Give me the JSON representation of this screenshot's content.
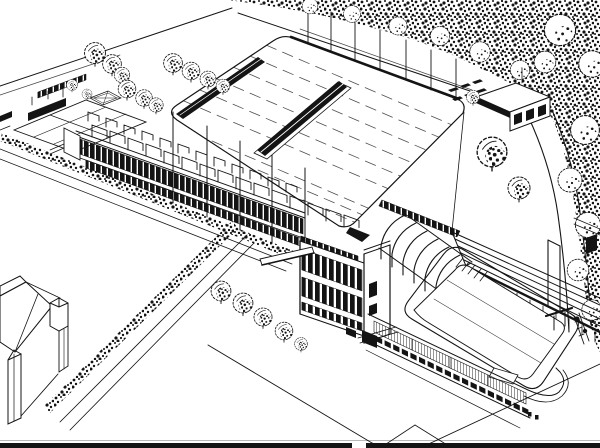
{
  "artwork": {
    "type": "aerial-perspective architectural line drawing",
    "subject": "Aerial perspective drawing of a swimming stadium complex: large flat-roofed hall with ridge skylight, entrance block with stair tower, shell-roofed stand, outdoor pool with diving platform and terraced grandstand, tennis court, pavilion, tree belt, hedges and a neighbouring house",
    "ink_color": "#141414",
    "paper_color": "#ffffff"
  },
  "scene": {
    "regions": [
      "main-hall-roof",
      "roof-ridge-skylight",
      "roof-edge-skylight",
      "roof-seam-lines",
      "flagpoles-north",
      "perimeter-road-north",
      "perimeter-road-east",
      "tree-canopy",
      "groundskeeper-pavilion",
      "crosswalk-markings",
      "tennis-court",
      "tennis-court-wall",
      "garden-fence",
      "garden-parterre",
      "west-wing",
      "clerestory-brackets",
      "ribbon-window-band",
      "forecourt-hedge",
      "forecourt-flagpoles",
      "entrance-block",
      "stair-tower",
      "entrance-canopy",
      "shell-roof-stand",
      "grandstand-terraces",
      "outdoor-pool",
      "diving-platform",
      "changing-room-wing",
      "neighbouring-house",
      "boundary-hedge",
      "tree-row",
      "lawn-paths",
      "drawing-border-bottom"
    ]
  }
}
